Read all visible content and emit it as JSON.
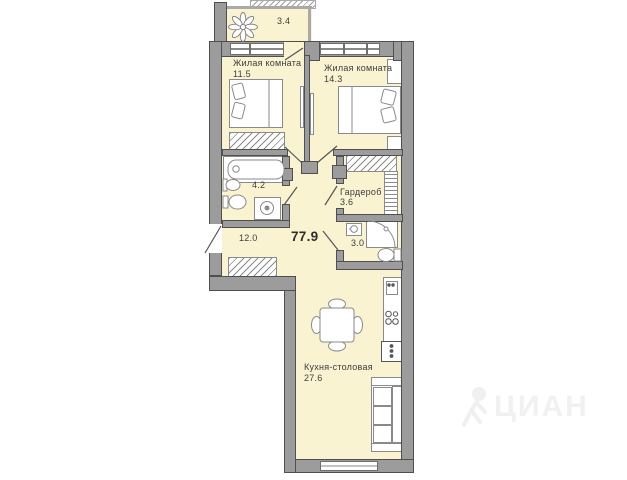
{
  "plan": {
    "total_area": "77.9",
    "watermark": "ЦИАН",
    "rooms": {
      "balcony": {
        "area": "3.4"
      },
      "bedroom1": {
        "name": "Жилая комната",
        "area": "11.5"
      },
      "bedroom2": {
        "name": "Жилая комната",
        "area": "14.3"
      },
      "bathroom": {
        "area": "4.2"
      },
      "wardrobe": {
        "name": "Гардероб",
        "area": "3.6"
      },
      "wc": {
        "area": "3.0"
      },
      "hallway": {
        "area": "12.0"
      },
      "kitchen": {
        "name": "Кухня-столовая",
        "area": "27.6"
      }
    },
    "colors": {
      "floor": "#FAF3D2",
      "wall": "#9C9C9C",
      "wall_outline": "#4F4F4F",
      "furniture_outline": "#8A8A8A",
      "text": "#3C3C3C",
      "watermark": "#F1F1F1"
    },
    "icons": [
      "flower-icon",
      "person-icon"
    ]
  }
}
